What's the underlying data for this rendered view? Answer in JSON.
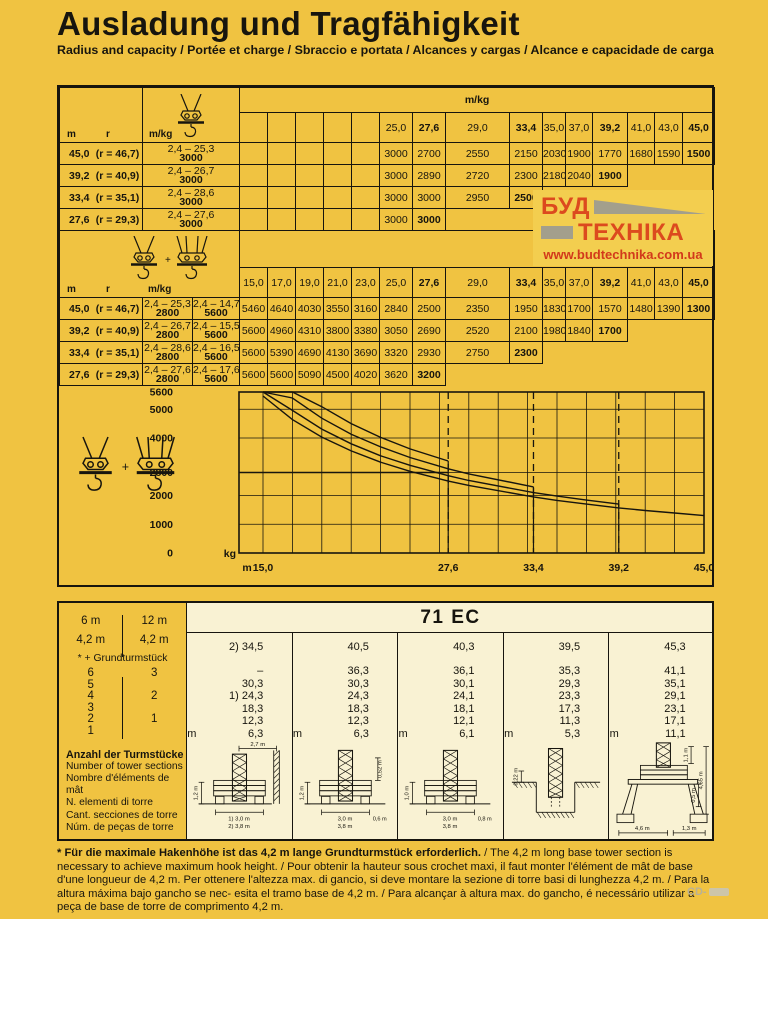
{
  "colors": {
    "page_bg": "#F0C341",
    "panel_cream": "#F9F2D3",
    "logo_red": "#DC4A1E",
    "logo_url_red": "#D2391B",
    "logo_gray": "#A39F8C",
    "line_black": "#17150e"
  },
  "header": {
    "title": "Ausladung und Tragfähigkeit",
    "subtitle": "Radius and capacity / Portée et charge / Sbraccio e portata / Alcances y cargas / Alcance e capacidade de carga"
  },
  "logo": {
    "word1": "БУД",
    "word2": "ТЕХНІКА",
    "url": "www.budtechnika.com.ua"
  },
  "table1": {
    "corner": {
      "m": "m",
      "r": "r",
      "unit": "m/kg"
    },
    "strip_label": "m/kg",
    "columns": [
      "",
      "",
      "",
      "",
      "",
      "25,0",
      "27,6",
      "29,0",
      "33,4",
      "35,0",
      "37,0",
      "39,2",
      "41,0",
      "43,0",
      "45,0"
    ],
    "bold_idx": [
      6,
      8,
      11,
      14
    ],
    "rows": [
      {
        "m": "45,0",
        "r": "(r = 46,7)",
        "range": "2,4 – 25,3",
        "max": "3000",
        "values": [
          "",
          "",
          "",
          "",
          "",
          "3000",
          "2700",
          "2550",
          "2150",
          "2030",
          "1900",
          "1770",
          "1680",
          "1590",
          "1500"
        ]
      },
      {
        "m": "39,2",
        "r": "(r = 40,9)",
        "range": "2,4 – 26,7",
        "max": "3000",
        "values": [
          "",
          "",
          "",
          "",
          "",
          "3000",
          "2890",
          "2720",
          "2300",
          "2180",
          "2040",
          "1900"
        ]
      },
      {
        "m": "33,4",
        "r": "(r = 35,1)",
        "range": "2,4 – 28,6",
        "max": "3000",
        "values": [
          "",
          "",
          "",
          "",
          "",
          "3000",
          "3000",
          "2950",
          "2500"
        ]
      },
      {
        "m": "27,6",
        "r": "(r = 29,3)",
        "range": "2,4 – 27,6",
        "max": "3000",
        "values": [
          "",
          "",
          "",
          "",
          "",
          "3000",
          "3000"
        ]
      }
    ]
  },
  "table2": {
    "corner": {
      "m": "m",
      "r": "r",
      "unit": "m/kg"
    },
    "columns": [
      "15,0",
      "17,0",
      "19,0",
      "21,0",
      "23,0",
      "25,0",
      "27,6",
      "29,0",
      "33,4",
      "35,0",
      "37,0",
      "39,2",
      "41,0",
      "43,0",
      "45,0"
    ],
    "bold_idx": [
      6,
      8,
      11,
      14
    ],
    "rows": [
      {
        "m": "45,0",
        "r": "(r = 46,7)",
        "range1": "2,4 – 25,3",
        "max1": "2800",
        "range2": "2,4 – 14,7",
        "max2": "5600",
        "values": [
          "5460",
          "4640",
          "4030",
          "3550",
          "3160",
          "2840",
          "2500",
          "2350",
          "1950",
          "1830",
          "1700",
          "1570",
          "1480",
          "1390",
          "1300"
        ]
      },
      {
        "m": "39,2",
        "r": "(r = 40,9)",
        "range1": "2,4 – 26,7",
        "max1": "2800",
        "range2": "2,4 – 15,5",
        "max2": "5600",
        "values": [
          "5600",
          "4960",
          "4310",
          "3800",
          "3380",
          "3050",
          "2690",
          "2520",
          "2100",
          "1980",
          "1840",
          "1700"
        ]
      },
      {
        "m": "33,4",
        "r": "(r = 35,1)",
        "range1": "2,4 – 28,6",
        "max1": "2800",
        "range2": "2,4 – 16,5",
        "max2": "5600",
        "values": [
          "5600",
          "5390",
          "4690",
          "4130",
          "3690",
          "3320",
          "2930",
          "2750",
          "2300"
        ]
      },
      {
        "m": "27,6",
        "r": "(r = 29,3)",
        "range1": "2,4 – 27,6",
        "max1": "2800",
        "range2": "2,4 – 17,6",
        "max2": "5600",
        "values": [
          "5600",
          "5600",
          "5090",
          "4500",
          "4020",
          "3620",
          "3200"
        ]
      }
    ]
  },
  "chart_data": {
    "type": "line",
    "title": "",
    "xlabel": "m",
    "ylabel": "kg",
    "xlim": [
      13.3,
      45.8
    ],
    "ylim": [
      0,
      5600
    ],
    "grid": true,
    "x_ticks": [
      15.0,
      27.6,
      33.4,
      39.2,
      45.0
    ],
    "x_tick_labels": [
      "15,0",
      "27,6",
      "33,4",
      "39,2",
      "45,0"
    ],
    "y_ticks": [
      0,
      1000,
      2000,
      2800,
      4000,
      5000,
      5600
    ],
    "y_tick_labels": [
      "0",
      "1000",
      "2000",
      "2800",
      "4000",
      "5000",
      "5600"
    ],
    "dashed_verticals": [
      27.6,
      33.4,
      39.2
    ],
    "horizontal_line_kg": 2800,
    "legend_position": "none",
    "series": [
      {
        "name": "jib 27,6 m",
        "x": [
          15,
          17,
          19,
          21,
          23,
          25,
          27.6
        ],
        "y": [
          5600,
          5600,
          5090,
          4500,
          4020,
          3620,
          3200
        ],
        "drop_to_zero": true
      },
      {
        "name": "jib 33,4 m",
        "x": [
          15,
          17,
          19,
          21,
          23,
          25,
          27.6,
          29,
          33.4
        ],
        "y": [
          5600,
          5390,
          4690,
          4130,
          3690,
          3320,
          2930,
          2750,
          2300
        ],
        "drop_to_zero": true
      },
      {
        "name": "jib 39,2 m",
        "x": [
          15,
          17,
          19,
          21,
          23,
          25,
          27.6,
          29,
          33.4,
          35,
          37,
          39.2
        ],
        "y": [
          5600,
          4960,
          4310,
          3800,
          3380,
          3050,
          2690,
          2520,
          2100,
          1980,
          1840,
          1700
        ],
        "drop_to_zero": true
      },
      {
        "name": "jib 45,0 m",
        "x": [
          15,
          17,
          19,
          21,
          23,
          25,
          27.6,
          29,
          33.4,
          35,
          37,
          39.2,
          41,
          43,
          45
        ],
        "y": [
          5460,
          4640,
          4030,
          3550,
          3160,
          2840,
          2500,
          2350,
          1950,
          1830,
          1700,
          1570,
          1480,
          1390,
          1300
        ],
        "drop_to_zero": false
      }
    ]
  },
  "bottom": {
    "title": "71 EC",
    "sidebar": {
      "col_left_header": "6 m",
      "col_right_header": "12 m",
      "base_left": "4,2 m",
      "base_right": "4,2 m",
      "note": "* + Grundturmstück",
      "pairs": [
        [
          "6",
          "3"
        ],
        [
          "5",
          ""
        ],
        [
          "4",
          "2"
        ],
        [
          "3",
          ""
        ],
        [
          "2",
          "1"
        ],
        [
          "1",
          ""
        ]
      ],
      "caption_bold": "Anzahl der Turmstücke",
      "captions": [
        "Number of tower sections",
        "Nombre d'éléments de mât",
        "N. elementi di torre",
        "Cant. secciones de torre",
        "Núm. de peças de torre"
      ]
    },
    "configs": [
      {
        "top": "2) 34,5",
        "heights": [
          "–",
          "30,3",
          "1) 24,3",
          "18,3",
          "12,3",
          "6,3"
        ],
        "unit": "m",
        "variant": "wall",
        "dims": {
          "top": "2,7 m",
          "left": "1,2 m",
          "bottom1": "1) 3,0 m",
          "bottom2": "2) 3,8 m"
        }
      },
      {
        "top": "40,5",
        "heights": [
          "36,3",
          "30,3",
          "24,3",
          "18,3",
          "12,3",
          "6,3"
        ],
        "unit": "m",
        "variant": "plain",
        "dims": {
          "left": "1,2 m",
          "right": "0,52 m",
          "bottom1": "3,0 m",
          "bottom2": "3,8 m",
          "offset": "0,6 m"
        }
      },
      {
        "top": "40,3",
        "heights": [
          "36,1",
          "30,1",
          "24,1",
          "18,1",
          "12,1",
          "6,1"
        ],
        "unit": "m",
        "variant": "plain",
        "dims": {
          "left": "1,0 m",
          "bottom1": "3,0 m",
          "bottom2": "3,8 m",
          "offset": "0,8 m"
        }
      },
      {
        "top": "39,5",
        "heights": [
          "35,3",
          "29,3",
          "23,3",
          "17,3",
          "11,3",
          "5,3"
        ],
        "unit": "m",
        "variant": "foundation",
        "dims": {
          "left": "0,22 m"
        }
      },
      {
        "top": "45,3",
        "heights": [
          "41,1",
          "35,1",
          "29,1",
          "23,1",
          "17,1",
          "11,1"
        ],
        "unit": "m",
        "variant": "cross-base",
        "dims": {
          "top": "1,1 m",
          "mid": "0,5 m",
          "right": "4,65 m",
          "bottom1": "4,6 m",
          "bottom2": "1,3 m"
        }
      }
    ]
  },
  "footnote": {
    "bold": "* Für die maximale Hakenhöhe ist das 4,2 m lange Grundturmstück erforderlich.",
    "rest": " / The 4,2 m long base tower section is necessary to achieve maximum hook height. / Pour obtenir la hauteur sous crochet maxi, il faut monter l'élément de mât de base d'une longueur de 4,2 m. Per ottenere l'altezza max. di gancio, si deve montare la sezione di torre basi di lunghezza 4,2 m. / Para la altura máxima bajo gancho se nec- esita el tramo base de 4,2 m. / Para alcançar à altura max. do gancho, é necessário utilizar a peça de base de torre de comprimento 4,2 m."
  },
  "watermark": {
    "text": "CD-"
  }
}
